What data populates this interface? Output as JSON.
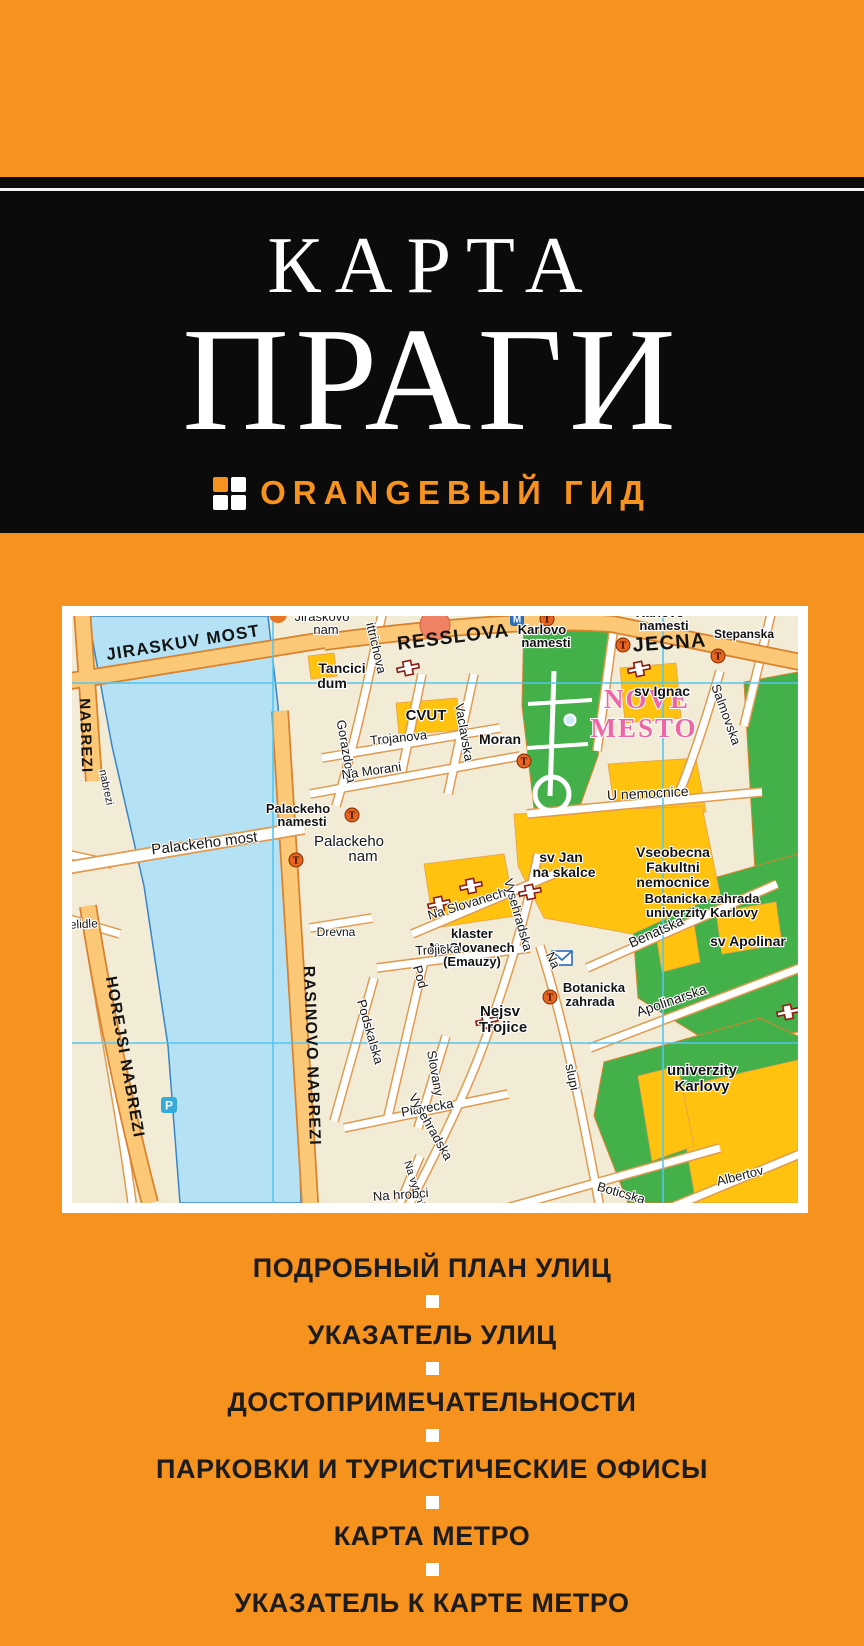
{
  "cover": {
    "title_line1": "КАРТА",
    "title_line2": "ПРАГИ",
    "brand": {
      "icon": "four-squares-grid-icon",
      "logo_text": "ORANGEВЫЙ ГИД"
    },
    "features": [
      "ПОДРОБНЫЙ ПЛАН УЛИЦ",
      "УКАЗАТЕЛЬ УЛИЦ",
      "ДОСТОПРИМЕЧАТЕЛЬНОСТИ",
      "ПАРКОВКИ И ТУРИСТИЧЕСКИЕ ОФИСЫ",
      "КАРТА МЕТРО",
      "УКАЗАТЕЛЬ К КАРТЕ МЕТРО"
    ],
    "colors": {
      "orange": "#F6921E",
      "black": "#0B0B0B",
      "white": "#FFFFFF",
      "feature_text": "#1C1C1C"
    }
  },
  "map": {
    "colors": {
      "land": "#F2ECD6",
      "water": "#B5E1F4",
      "park_green": "#44B049",
      "building_yellow": "#FFC20E",
      "road_orange": "#FBC878",
      "grid_cyan": "#55C6EF",
      "district_pink": "#EE66A3",
      "church_red": "#8B1C12",
      "metro_orange": "#E8641F",
      "info_blue": "#2B6CB8"
    },
    "labels": [
      {
        "t": "JIRASKUV MOST",
        "x": 112,
        "y": 32,
        "r": -9,
        "s": 17,
        "c": "mj"
      },
      {
        "t": "RESSLOVA",
        "x": 382,
        "y": 27,
        "r": -7,
        "s": 19,
        "c": "mj"
      },
      {
        "t": "JECNA",
        "x": 598,
        "y": 33,
        "r": -4,
        "s": 20,
        "c": "mj"
      },
      {
        "t": "NABREZI",
        "x": 9,
        "y": 120,
        "r": 88,
        "s": 15,
        "c": "mj"
      },
      {
        "t": "HOREJSI NABREZI",
        "x": 48,
        "y": 442,
        "r": 80,
        "s": 16,
        "c": "mj"
      },
      {
        "t": "RASINOVO NABREZI",
        "x": 235,
        "y": 440,
        "r": 88,
        "s": 16,
        "c": "mj"
      },
      {
        "t": "NOVE",
        "x": 575,
        "y": 92,
        "s": 27,
        "c": "pk"
      },
      {
        "t": "MESTO",
        "x": 572,
        "y": 121,
        "s": 27,
        "c": "pk"
      },
      {
        "t": "Jiraskovo",
        "x": 250,
        "y": 5,
        "s": 13,
        "c": "st"
      },
      {
        "t": "nam",
        "x": 254,
        "y": 18,
        "s": 13,
        "c": "st"
      },
      {
        "t": "Tancici",
        "x": 270,
        "y": 57,
        "s": 14,
        "c": "bd"
      },
      {
        "t": "dum",
        "x": 260,
        "y": 72,
        "s": 14,
        "c": "bd"
      },
      {
        "t": "CVUT",
        "x": 354,
        "y": 104,
        "s": 15,
        "c": "bd"
      },
      {
        "t": "Moran",
        "x": 428,
        "y": 128,
        "s": 14,
        "c": "bd"
      },
      {
        "t": "Karlovo",
        "x": 470,
        "y": 18,
        "s": 13,
        "c": "bd"
      },
      {
        "t": "namesti",
        "x": 474,
        "y": 31,
        "s": 13,
        "c": "bd"
      },
      {
        "t": "Karlovo",
        "x": 588,
        "y": 1,
        "s": 13,
        "c": "bd"
      },
      {
        "t": "namesti",
        "x": 592,
        "y": 14,
        "s": 13,
        "c": "bd"
      },
      {
        "t": "Stepanska",
        "x": 672,
        "y": 22,
        "s": 12,
        "c": "bd"
      },
      {
        "t": "sv Ignac",
        "x": 590,
        "y": 80,
        "s": 14,
        "c": "bd"
      },
      {
        "t": "Salmovska",
        "x": 650,
        "y": 100,
        "r": 70,
        "s": 13,
        "c": "st"
      },
      {
        "t": "ittrichova",
        "x": 300,
        "y": 33,
        "r": 77,
        "s": 13,
        "c": "st"
      },
      {
        "t": "Gorazdova",
        "x": 270,
        "y": 136,
        "r": 80,
        "s": 13,
        "c": "st"
      },
      {
        "t": "Vaclavska",
        "x": 388,
        "y": 117,
        "r": 80,
        "s": 13,
        "c": "st"
      },
      {
        "t": "Trojanova",
        "x": 327,
        "y": 126,
        "r": -6,
        "s": 13,
        "c": "st"
      },
      {
        "t": "Na Morani",
        "x": 300,
        "y": 159,
        "r": -8,
        "s": 13,
        "c": "st"
      },
      {
        "t": "Palackeho",
        "x": 226,
        "y": 197,
        "s": 13,
        "c": "bd"
      },
      {
        "t": "namesti",
        "x": 230,
        "y": 210,
        "s": 13,
        "c": "bd"
      },
      {
        "t": "Palackeho most",
        "x": 133,
        "y": 232,
        "r": -7,
        "s": 15,
        "c": "st"
      },
      {
        "t": "Palackeho",
        "x": 277,
        "y": 230,
        "s": 15,
        "c": "st"
      },
      {
        "t": "nam",
        "x": 291,
        "y": 245,
        "s": 15,
        "c": "st"
      },
      {
        "t": "U nemocnice",
        "x": 576,
        "y": 182,
        "r": -3,
        "s": 14,
        "c": "st"
      },
      {
        "t": "sv Jan",
        "x": 489,
        "y": 246,
        "s": 14,
        "c": "bd"
      },
      {
        "t": "na skalce",
        "x": 492,
        "y": 261,
        "s": 14,
        "c": "bd"
      },
      {
        "t": "Vseobecna",
        "x": 601,
        "y": 241,
        "s": 14,
        "c": "bd"
      },
      {
        "t": "Fakultni",
        "x": 601,
        "y": 256,
        "s": 14,
        "c": "bd"
      },
      {
        "t": "nemocnice",
        "x": 601,
        "y": 271,
        "s": 14,
        "c": "bd"
      },
      {
        "t": "Na Slovanech",
        "x": 396,
        "y": 292,
        "r": -17,
        "s": 13,
        "c": "st"
      },
      {
        "t": "klaster",
        "x": 400,
        "y": 322,
        "s": 13,
        "c": "bd"
      },
      {
        "t": "Na Slovanech",
        "x": 400,
        "y": 336,
        "s": 13,
        "c": "bd"
      },
      {
        "t": "(Emauzy)",
        "x": 400,
        "y": 350,
        "s": 13,
        "c": "bd"
      },
      {
        "t": "Vysehradska",
        "x": 442,
        "y": 300,
        "r": 74,
        "s": 13,
        "c": "st"
      },
      {
        "t": "Benatska",
        "x": 586,
        "y": 320,
        "r": -24,
        "s": 14,
        "c": "st"
      },
      {
        "t": "Botanicka zahrada",
        "x": 630,
        "y": 287,
        "s": 13,
        "c": "bd"
      },
      {
        "t": "univerzity Karlovy",
        "x": 630,
        "y": 301,
        "s": 13,
        "c": "bd"
      },
      {
        "t": "sv Apolinar",
        "x": 676,
        "y": 330,
        "s": 14,
        "c": "bd"
      },
      {
        "t": "Botanicka",
        "x": 522,
        "y": 376,
        "s": 13,
        "c": "bd"
      },
      {
        "t": "zahrada",
        "x": 518,
        "y": 390,
        "s": 13,
        "c": "bd"
      },
      {
        "t": "Apolinarska",
        "x": 601,
        "y": 389,
        "r": -19,
        "s": 14,
        "c": "st"
      },
      {
        "t": "Na",
        "x": 477,
        "y": 346,
        "r": 65,
        "s": 13,
        "c": "st"
      },
      {
        "t": "slupi",
        "x": 496,
        "y": 462,
        "r": 78,
        "s": 13,
        "c": "st"
      },
      {
        "t": "univerzity",
        "x": 630,
        "y": 459,
        "s": 15,
        "c": "bd"
      },
      {
        "t": "Karlovy",
        "x": 630,
        "y": 475,
        "s": 15,
        "c": "bd"
      },
      {
        "t": "Albertov",
        "x": 669,
        "y": 564,
        "r": -14,
        "s": 13,
        "c": "st"
      },
      {
        "t": "Trojicka",
        "x": 366,
        "y": 338,
        "r": -3,
        "s": 13,
        "c": "st"
      },
      {
        "t": "Nejsv",
        "x": 428,
        "y": 400,
        "s": 15,
        "c": "bd"
      },
      {
        "t": "Trojice",
        "x": 431,
        "y": 416,
        "s": 15,
        "c": "bd"
      },
      {
        "t": "Pod",
        "x": 344,
        "y": 362,
        "r": 74,
        "s": 13,
        "c": "st"
      },
      {
        "t": "Podskalska",
        "x": 294,
        "y": 417,
        "r": 74,
        "s": 13,
        "c": "st"
      },
      {
        "t": "Slovany",
        "x": 359,
        "y": 458,
        "r": 80,
        "s": 13,
        "c": "st"
      },
      {
        "t": "Plavecka",
        "x": 356,
        "y": 496,
        "r": -10,
        "s": 13,
        "c": "st"
      },
      {
        "t": "Drevna",
        "x": 264,
        "y": 320,
        "s": 12,
        "c": "st"
      },
      {
        "t": "Na vytoni",
        "x": 339,
        "y": 568,
        "r": 72,
        "s": 11,
        "c": "st"
      },
      {
        "t": "Vysehradska",
        "x": 355,
        "y": 513,
        "r": 60,
        "s": 13,
        "c": "st"
      },
      {
        "t": "Boticska",
        "x": 548,
        "y": 581,
        "r": 16,
        "s": 13,
        "c": "st"
      },
      {
        "t": "Na hrobci",
        "x": 329,
        "y": 583,
        "r": -4,
        "s": 13,
        "c": "st"
      },
      {
        "t": "nabrezi",
        "x": 31,
        "y": 172,
        "r": 78,
        "s": 11,
        "c": "st"
      },
      {
        "t": "elidle",
        "x": 12,
        "y": 312,
        "r": -3,
        "s": 12,
        "c": "st"
      }
    ],
    "icons": [
      {
        "type": "poi",
        "x": 363,
        "y": 9
      },
      {
        "type": "poi-small",
        "x": 206,
        "y": -2
      },
      {
        "type": "metro-entrance",
        "glyph": "M",
        "x": 445,
        "y": 3
      },
      {
        "type": "metro-station",
        "glyph": "T",
        "x": 475,
        "y": 3
      },
      {
        "type": "metro-station",
        "glyph": "T",
        "x": 551,
        "y": 29
      },
      {
        "type": "metro-station",
        "glyph": "T",
        "x": 646,
        "y": 40
      },
      {
        "type": "metro-station",
        "glyph": "T",
        "x": 452,
        "y": 145
      },
      {
        "type": "metro-station",
        "glyph": "T",
        "x": 280,
        "y": 199
      },
      {
        "type": "metro-station",
        "glyph": "T",
        "x": 224,
        "y": 244
      },
      {
        "type": "metro-station",
        "glyph": "T",
        "x": 478,
        "y": 381
      },
      {
        "type": "parking",
        "glyph": "P",
        "x": 97,
        "y": 489
      },
      {
        "type": "post-office",
        "x": 490,
        "y": 342
      },
      {
        "type": "church",
        "x": 336,
        "y": 52
      },
      {
        "type": "church",
        "x": 567,
        "y": 53
      },
      {
        "type": "church",
        "x": 399,
        "y": 270
      },
      {
        "type": "church",
        "x": 367,
        "y": 288
      },
      {
        "type": "church",
        "x": 458,
        "y": 276
      },
      {
        "type": "church",
        "x": 415,
        "y": 405
      },
      {
        "type": "church",
        "x": 716,
        "y": 396
      }
    ]
  }
}
